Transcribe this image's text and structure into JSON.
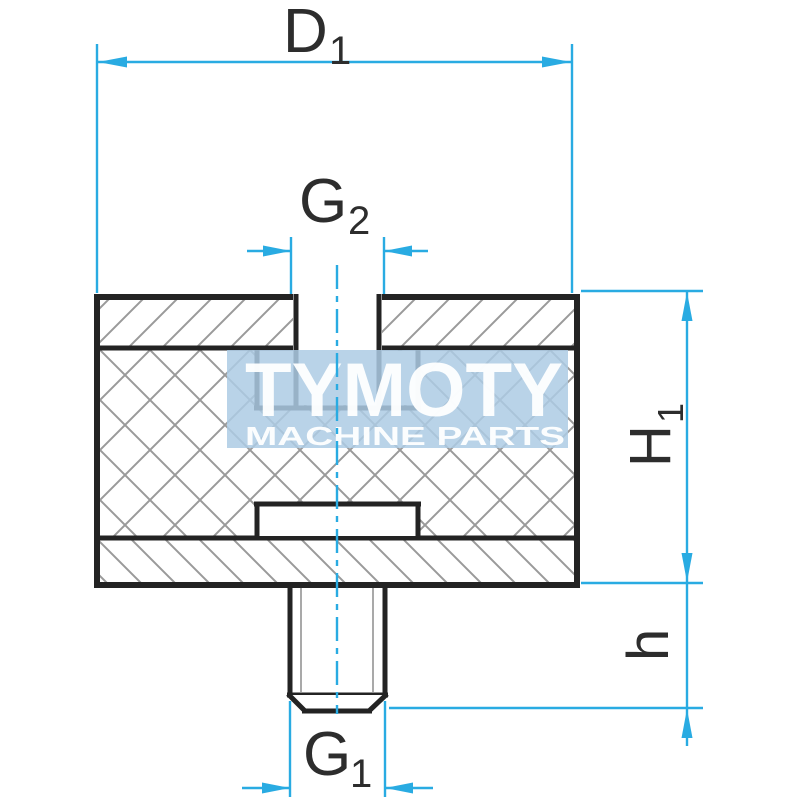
{
  "drawing_title": "rubber-metal buffer sectional drawing",
  "watermark": {
    "brand": "TYMOTY",
    "tagline": "MACHINE PARTS"
  },
  "labels": {
    "d1": {
      "base": "D",
      "sub": "1"
    },
    "g2": {
      "base": "G",
      "sub": "2"
    },
    "g1": {
      "base": "G",
      "sub": "1"
    },
    "h1": {
      "base": "H",
      "sub": "1"
    },
    "h": {
      "base": "h"
    }
  },
  "colors": {
    "dim_blue": "#29abe2",
    "line_black": "#232323",
    "label_ink": "#2d2d2d",
    "hatch_gray": "#9a9a9a",
    "thread_gray": "#a9a9a9",
    "watermark_fill": "#adcbe4",
    "watermark_text": "#ffffff",
    "paper": "#ffffff"
  }
}
